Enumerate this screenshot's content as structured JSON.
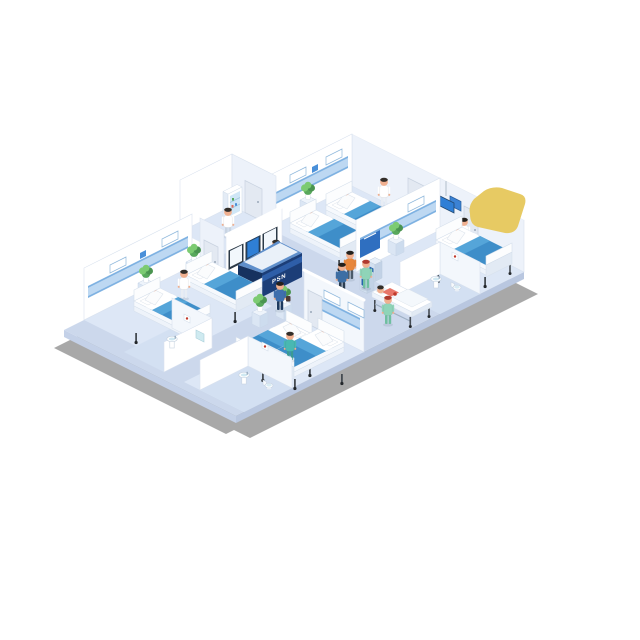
{
  "page": {
    "background": "#ffffff",
    "title": "Isometric hospital ward illustration"
  },
  "reception": {
    "desk_label": "PSN"
  },
  "colors": {
    "shadow": "#a8a8a8",
    "floor": "#ccd8ec",
    "floor_room": "#dde7f6",
    "floor_bath": "#d3e0f2",
    "slab": "#b9c7e0",
    "slab2": "#c4d1e8",
    "wall": "#ffffff",
    "wall_sw": "#f3f7fc",
    "wall_int": "#edf2fa",
    "wall_edge": "#d9e2ee",
    "band": "#bdd8f2",
    "band_line": "#7fb2e2",
    "mattress": "#3e8ec9",
    "mattress_light": "#55a5d9",
    "bedframe": "#eef3fa",
    "desk_navy": "#1c3e78",
    "desk_dark": "#16325f",
    "desk_top": "#5f8fcb",
    "screen_blue": "#2f7fd6",
    "poster_blue": "#2f6fc0",
    "kiosk_screen": "#2765ad",
    "door": "#e3e9f2",
    "plant_dark": "#4a9450",
    "plant_mid": "#58a85c",
    "plant_light": "#7ccb72",
    "skin": "#f0b090",
    "hair_dark": "#332e29",
    "hair_red": "#b03a2e",
    "scrubs_green": "#8fd4b8",
    "scrubs_teal": "#49b8b2",
    "suit_blue": "#3f6fae",
    "shirt_orange": "#e8873c",
    "shirt_blue": "#3c6ea5",
    "gown_coral": "#e8766a",
    "metal": "#454b52",
    "caster": "#23272b",
    "sign_blue": "#4a90d9",
    "yellow": "#e7ca63"
  },
  "scene": {
    "rooms": [
      {
        "id": "ward-top",
        "type": "patient-room",
        "beds": 2,
        "patients": 2,
        "nurses": 1,
        "plants": 1
      },
      {
        "id": "ward-right",
        "type": "patient-room",
        "beds": 1,
        "patients": 1,
        "doctors": 1,
        "plants": 1,
        "ensuite_bathroom": true,
        "overhead_monitor": true
      },
      {
        "id": "ward-left",
        "type": "patient-room",
        "beds": 2,
        "patients": 2,
        "nurses": 1,
        "plants": 2,
        "ensuite_bathroom": true
      },
      {
        "id": "ward-bottom",
        "type": "patient-room",
        "beds": 2,
        "patients": 2,
        "nurses": 1,
        "plants": 2,
        "ensuite_bathroom": true
      },
      {
        "id": "pharmacy",
        "type": "supply-room",
        "staff": 1,
        "medicine_cabinet": true
      },
      {
        "id": "nurse-station",
        "type": "reception",
        "staff": 1,
        "wall_monitors": 3,
        "desk": true
      }
    ],
    "corridor": {
      "self_service_kiosks": 2,
      "kiosk_users": 2,
      "stretcher": {
        "patients": 1,
        "nurses": 1
      },
      "walking_people": [
        "man-in-suit",
        "nurse-in-green"
      ]
    }
  }
}
